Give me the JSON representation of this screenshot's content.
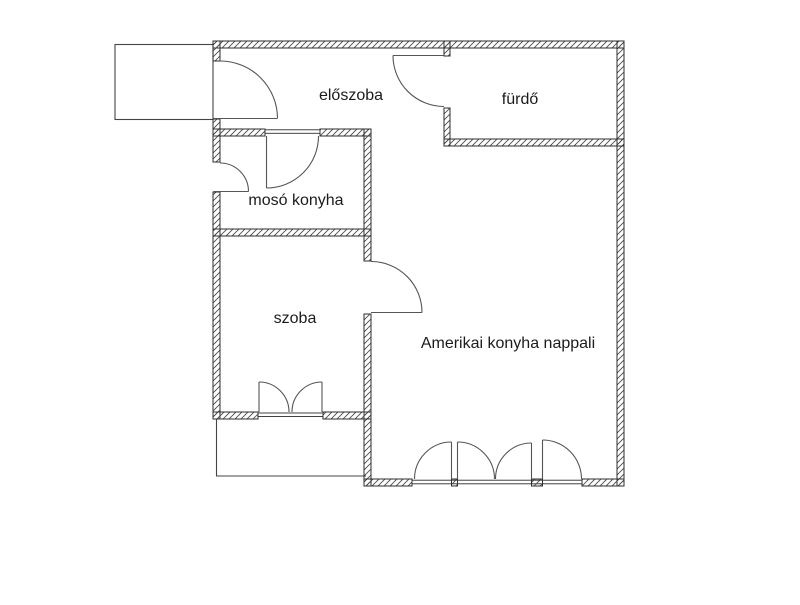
{
  "page": {
    "title": "Lakás alaprajz",
    "type": "floor-plan"
  },
  "rooms": [
    {
      "id": "eloszoba",
      "label": "előszoba"
    },
    {
      "id": "furdo",
      "label": "fürdő"
    },
    {
      "id": "moso",
      "label": "mosó konyha"
    },
    {
      "id": "szoba",
      "label": "szoba"
    },
    {
      "id": "nappali",
      "label": "Amerikai konyha nappali"
    }
  ],
  "colors": {
    "wall_line": "#2e2e2e",
    "hatch_line": "#4a4a4a",
    "door_line": "#555555",
    "thin_line": "#444444",
    "text": "#1b1b1b",
    "background": "#ffffff"
  }
}
